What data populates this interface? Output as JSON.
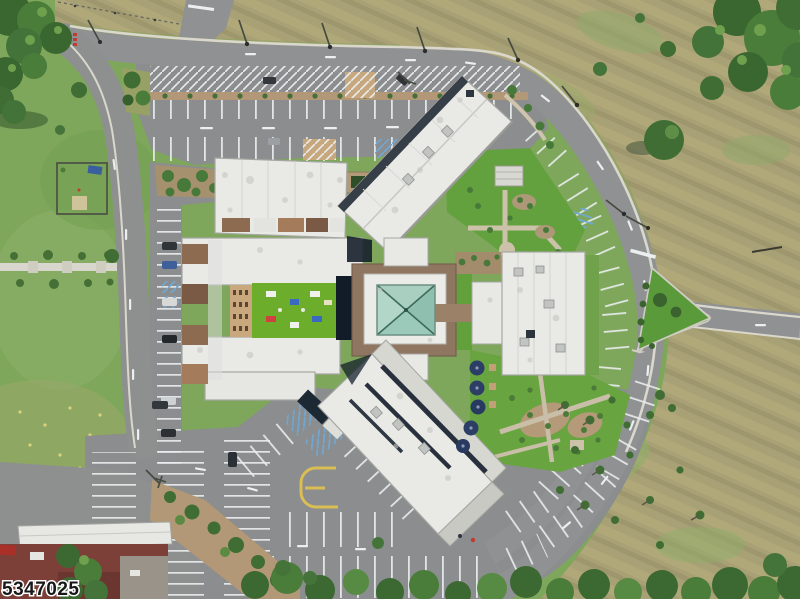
{
  "image": {
    "type": "aerial-drone-photo",
    "description": "Top-down aerial view of a large multi-wing building complex with a central glass pyramid atrium skylight, a bright green rooftop turf courtyard, white membrane roofs, surrounding parking lots with striped stalls, a curved perimeter access road with a triangular grass island, lawns, mowed tan fields and trees",
    "width_px": 800,
    "height_px": 599
  },
  "watermark": {
    "text": "5347025"
  },
  "colors": {
    "grass": "#7ea75c",
    "lawn": "#63a13e",
    "field_tan": "#a9a176",
    "road": "#8f9192",
    "parking_asphalt": "#8b8d8e",
    "curb_concrete": "#dad7cc",
    "roof_white": "#e9e9e6",
    "roof_brown": "#8d6b50",
    "facade_tan": "#c9a87e",
    "turf_courtyard": "#6cae2c",
    "skylight_glass": "#9ccaba",
    "skylight_ridge": "#3d6b5c",
    "building_shadow": "#16202c",
    "umbrella_navy": "#2c3e66",
    "mulch": "#b29877",
    "tree_green": "#3f6d33",
    "marking_white": "#eceff0",
    "marking_yellow": "#d9bd55",
    "marking_blue": "#6fa8d4",
    "brick_red": "#7d4038",
    "car_red": "#a83028",
    "watermark_fill": "#181818",
    "watermark_outline": "#ffffff"
  },
  "scene": {
    "features": [
      "central-pyramid-atrium-skylight",
      "rooftop-turf-courtyard",
      "north-block-roof",
      "northeast-wing-roof",
      "west-wing-roof",
      "east-wing-roof",
      "southwest-wing-roof",
      "top-parking-lot",
      "left-parallel-parking",
      "bottom-left-parking-lot",
      "curved-right-parking",
      "perimeter-road",
      "triangle-grass-island",
      "fenced-pen",
      "patio-umbrellas",
      "gardens-and-paths",
      "tan-mowed-field",
      "tree-canopies",
      "annex-building",
      "watermark"
    ]
  }
}
